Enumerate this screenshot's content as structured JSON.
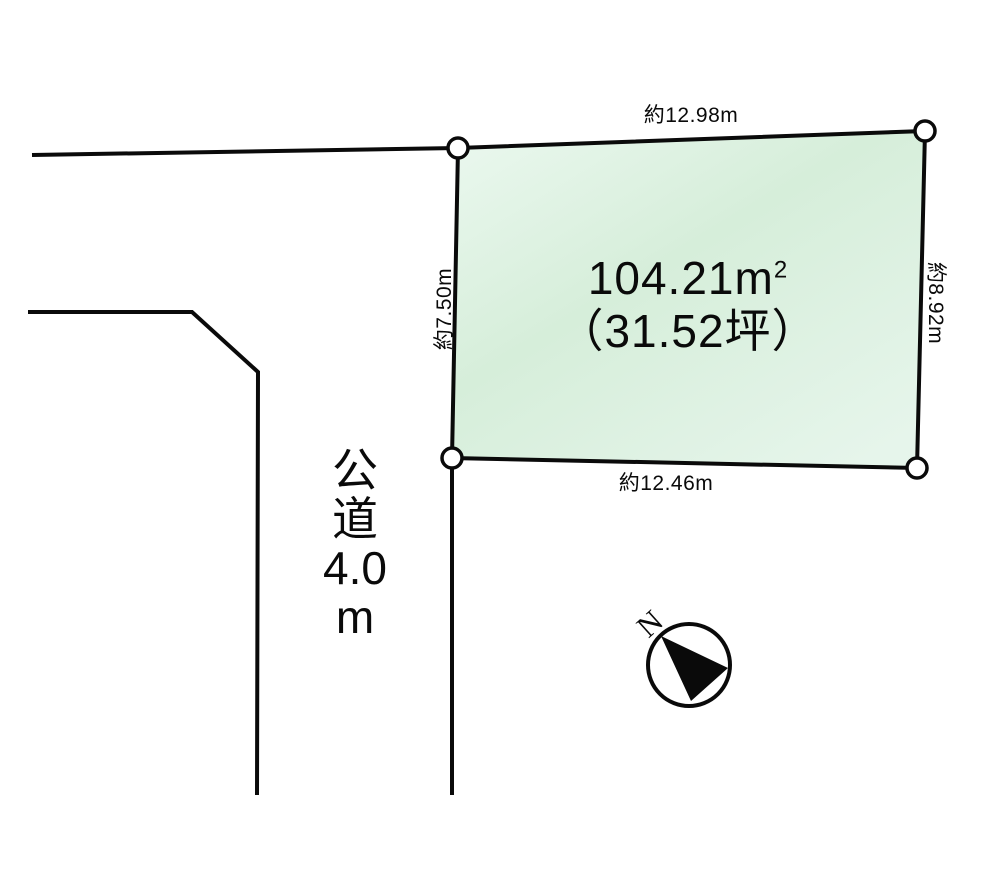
{
  "diagram": {
    "title": "land-plot-diagram",
    "background_color": "#ffffff",
    "line_color": "#0a0a0a",
    "plot_fill_light": "#ebf8ef",
    "plot_fill_mid": "#d6eeda",
    "plot_fill_end": "#e6f5eb"
  },
  "plot": {
    "area_value": "104.21m",
    "area_superscript": "2",
    "area_tsubo": "（31.52坪）",
    "dimensions": {
      "top": "約12.98m",
      "right": "約8.92m",
      "bottom": "約12.46m",
      "left": "約7.50m"
    }
  },
  "road": {
    "label_lines": [
      "公",
      "道",
      "4.0",
      "m"
    ]
  },
  "compass": {
    "north_label": "N"
  }
}
